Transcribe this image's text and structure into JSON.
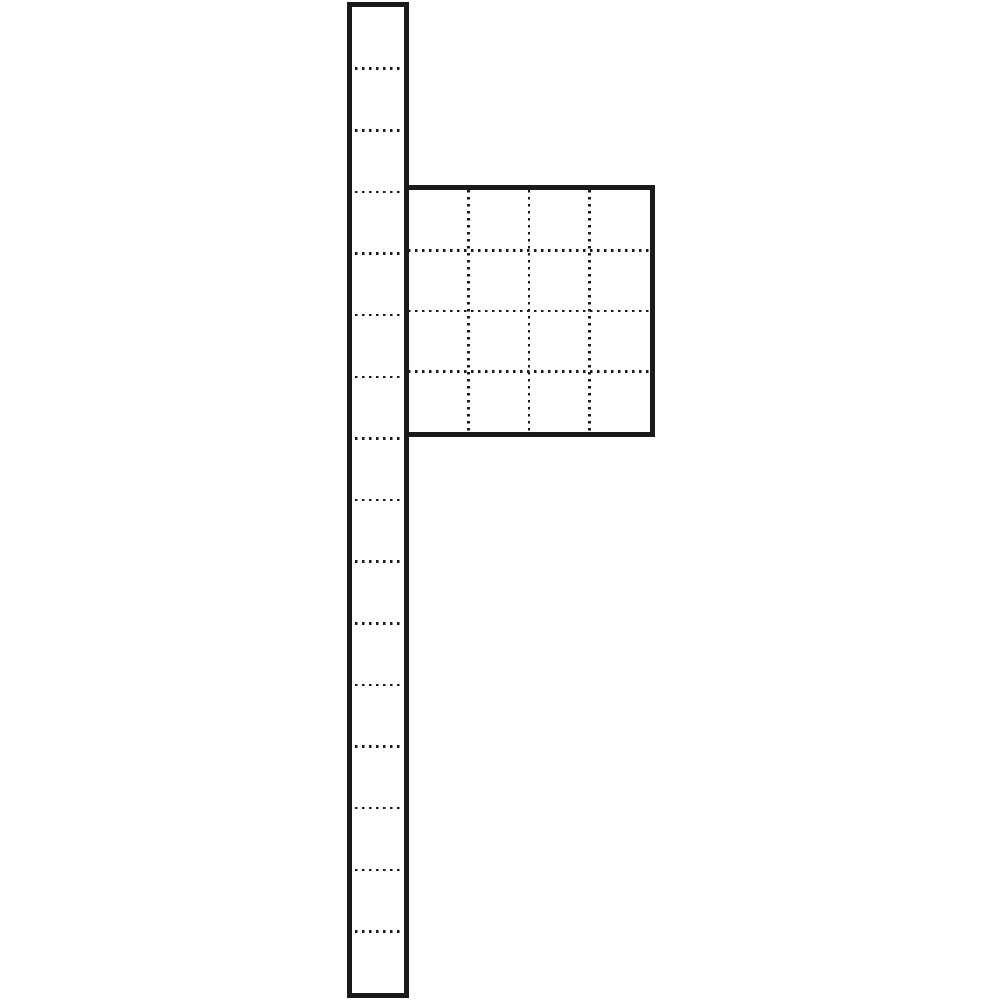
{
  "canvas": {
    "width": 1000,
    "height": 1000,
    "background": "#ffffff"
  },
  "drawing": {
    "kind": "technical-line-drawing",
    "line_color": "#1a1a1a",
    "border_width": 5,
    "dot_thickness": 2.5,
    "dot_size": 2.5,
    "dot_period": 7,
    "post": {
      "x": 347,
      "y": 2,
      "width": 62,
      "height": 996,
      "segments": 16,
      "dot_inset": 3
    },
    "panel": {
      "x": 403,
      "y": 185,
      "width": 252,
      "height": 252,
      "cols": 4,
      "rows": 4
    }
  }
}
